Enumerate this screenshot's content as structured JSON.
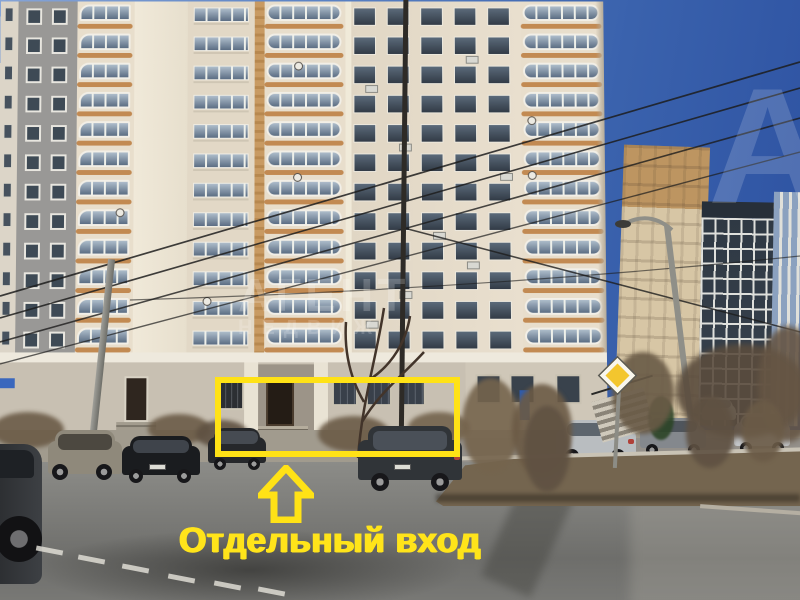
{
  "annotation": {
    "caption": "Отдельный вход",
    "highlight_color": "#ffe216",
    "box_shape": "rectangle-outline",
    "arrow_direction": "up"
  },
  "watermark": {
    "center_line1": "АГЕНТ",
    "center_line2": "НЕДВИЖ",
    "corner_text": "АН",
    "color": "#ffffff"
  },
  "street_sign": {
    "name": "priority-road-sign",
    "color": "#f3c62e"
  },
  "scene": {
    "subject": "apartment-building-street-photo",
    "sky_color": "#3a62ad",
    "facade_color": "#e5dbc9",
    "trim_color": "#c28a52"
  }
}
